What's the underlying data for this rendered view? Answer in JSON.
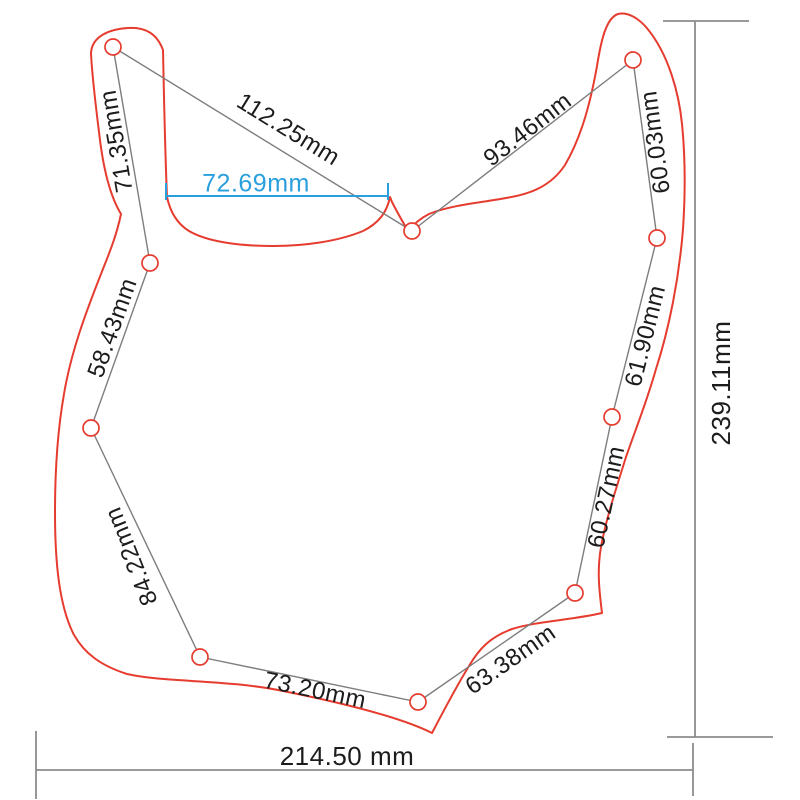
{
  "drawing": {
    "description": "Pickguard outline dimension drawing with screw holes",
    "hole_count": 10,
    "unit": "mm",
    "colors": {
      "outline_red": "#e63c2f",
      "highlight_blue": "#2a9fdd",
      "measure_line_gray": "#7d7d7d",
      "dimension_line_gray": "#8c8c8c",
      "text_black": "#1c1c1c"
    },
    "measurements": [
      {
        "name": "top-left-hole-to-center-hole",
        "label": "112.25mm",
        "value_mm": 112.25
      },
      {
        "name": "center-hole-to-top-right-hole",
        "label": "93.46mm",
        "value_mm": 93.46
      },
      {
        "name": "top-left-hole-to-left-mid-hole",
        "label": "71.35mm",
        "value_mm": 71.35
      },
      {
        "name": "top-right-hole-to-right-upper-hole",
        "label": "60.03mm",
        "value_mm": 60.03
      },
      {
        "name": "left-mid-to-left-lower-hole",
        "label": "58.43mm",
        "value_mm": 58.43
      },
      {
        "name": "right-upper-to-right-mid-hole",
        "label": "61.90mm",
        "value_mm": 61.9
      },
      {
        "name": "left-lower-to-bottom-left-hole",
        "label": "84.22mm",
        "value_mm": 84.22
      },
      {
        "name": "right-mid-to-right-lower-hole",
        "label": "60.27mm",
        "value_mm": 60.27
      },
      {
        "name": "bottom-left-to-bottom-center-hole",
        "label": "73.20mm",
        "value_mm": 73.2
      },
      {
        "name": "bottom-center-to-right-lower-hole",
        "label": "63.38mm",
        "value_mm": 63.38
      },
      {
        "name": "cutout-edge-width-highlight",
        "label": "72.69mm",
        "value_mm": 72.69
      },
      {
        "name": "overall-height",
        "label": "239.11mm",
        "value_mm": 239.11
      },
      {
        "name": "overall-width",
        "label": "214.50 mm",
        "value_mm": 214.5
      }
    ]
  }
}
